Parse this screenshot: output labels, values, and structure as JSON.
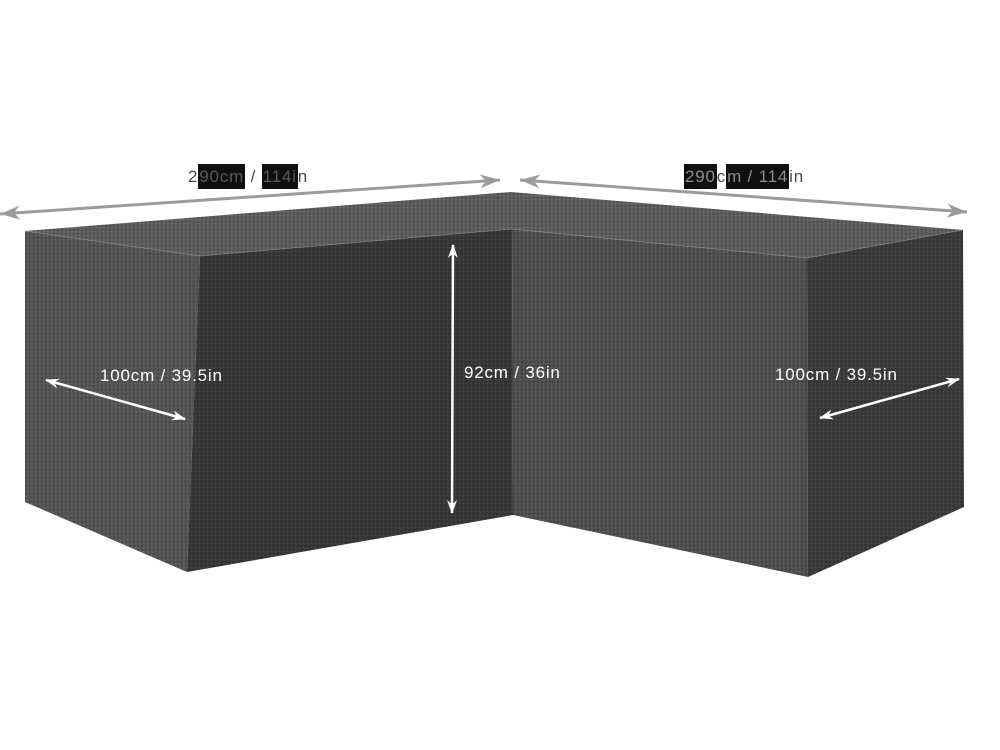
{
  "diagram": {
    "background": "#ffffff",
    "dimensions": {
      "top_left": {
        "text": "290cm / 114in",
        "segments": [
          {
            "t": "2",
            "h": false
          },
          {
            "t": "90cm",
            "h": true
          },
          {
            "t": " / ",
            "h": false
          },
          {
            "t": "114i",
            "h": true
          },
          {
            "t": "n",
            "h": false
          }
        ]
      },
      "top_right": {
        "text": "290cm / 114in",
        "segments": [
          {
            "t": "290",
            "h": true
          },
          {
            "t": "c",
            "h": false
          },
          {
            "t": "m / 114",
            "h": true
          },
          {
            "t": "in",
            "h": false
          }
        ]
      },
      "depth_left": {
        "text": "100cm / 39.5in"
      },
      "height": {
        "text": "92cm / 36in"
      },
      "depth_right": {
        "text": "100cm / 39.5in"
      }
    },
    "colors": {
      "face_top": "#5e5e5e",
      "face_left_end": "#565656",
      "face_left_inner": "#383838",
      "face_right_inner": "#505050",
      "face_right_end": "#3b3b3b",
      "edge_highlight": "rgba(255,255,255,0.18)",
      "arrow_gray": "#9b9b9b",
      "arrow_white": "#ffffff",
      "label_dark": "#4a4a4a",
      "label_highlight_bg": "#0f0f0f",
      "label_white": "#ffffff"
    }
  }
}
